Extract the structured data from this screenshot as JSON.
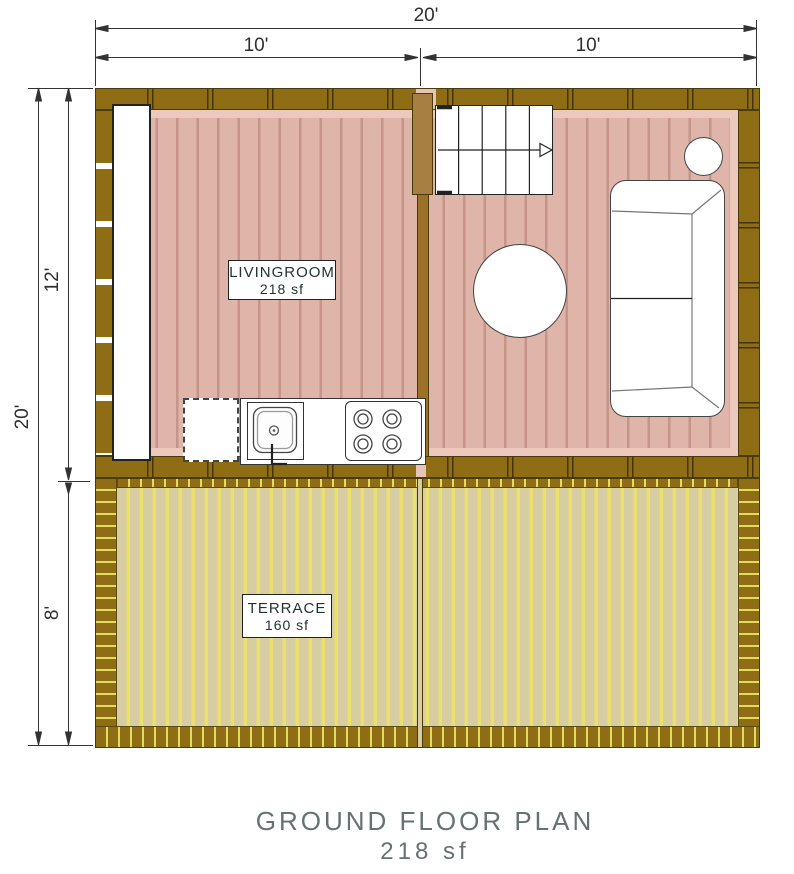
{
  "plan": {
    "title_line1": "GROUND FLOOR PLAN",
    "title_line2": "218 sf",
    "rooms": [
      {
        "name": "LIVINGROOM",
        "area": "218 sf"
      },
      {
        "name": "TERRACE",
        "area": "160 sf"
      }
    ],
    "dimensions": {
      "top_total": "20'",
      "top_left_span": "10'",
      "top_right_span": "10'",
      "left_total": "20'",
      "left_upper_span": "12'",
      "left_lower_span": "8'"
    },
    "furniture_icons": [
      "wall-counter",
      "refrigerator",
      "kitchen-sink",
      "stove",
      "stairs",
      "round-table",
      "sofa",
      "side-table"
    ],
    "colors": {
      "exterior_wall": "#8e6d14",
      "interior_wall": "#9c7127",
      "living_floor": "#e0b5a9",
      "living_plank_line": "#c59589",
      "living_floor_band": "#ecc9bc",
      "terrace_floor": "#d8cda2",
      "terrace_stripe": "#e9e16b",
      "dimension_line": "#333333",
      "title_text": "#667171"
    }
  }
}
